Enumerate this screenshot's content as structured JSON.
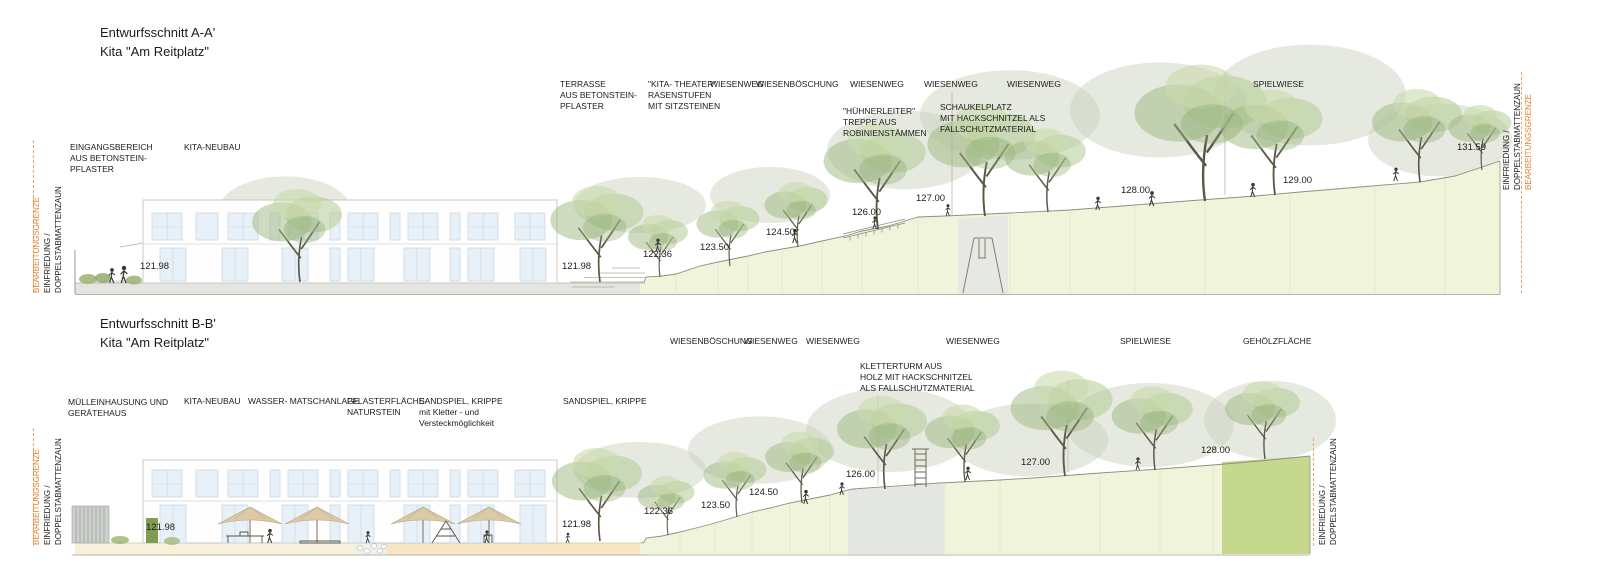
{
  "sections": [
    {
      "name": "A",
      "title": "Entwurfsschnitt A-A'\nKita \"Am Reitplatz\"",
      "edge_left": {
        "grenze": "BEARBEITUNGSGRENZE",
        "fence1": "EINFRIEDUNG /",
        "fence2": "DOPPELSTABMATTENZAUN"
      },
      "edge_right": {
        "fence1": "EINFRIEDUNG /",
        "fence2": "DOPPELSTABMATTENZAUN",
        "grenze": "BEARBEITUNGSGRENZE"
      },
      "labels": [
        "EINGANGSBEREICH\nAUS BETONSTEIN-\nPFLASTER",
        "KITA-NEUBAU",
        "TERRASSE\nAUS BETONSTEIN-\nPFLASTER",
        "\"KITA- THEATER\"\nRASENSTUFEN\nMIT SITZSTEINEN",
        "WIESENWEG",
        "WIESENBÖSCHUNG",
        "WIESENWEG",
        "WIESENWEG",
        "WIESENWEG",
        "SPIELWIESE",
        "\"HÜHNERLEITER\"\nTREPPE AUS\nROBINIENSTÄMMEN",
        "SCHAUKELPLATZ\nMIT HACKSCHNITZEL ALS\nFALLSCHUTZMATERIAL"
      ],
      "elevations": [
        "121.98",
        "121.98",
        "122.36",
        "123.50",
        "124.50",
        "126.00",
        "127.00",
        "128.00",
        "129.00",
        "131.59"
      ]
    },
    {
      "name": "B",
      "title": "Entwurfsschnitt B-B'\nKita \"Am Reitplatz\"",
      "edge_left": {
        "grenze": "BEARBEITUNGSGRENZE",
        "fence1": "EINFRIEDUNG /",
        "fence2": "DOPPELSTABMATTENZAUN"
      },
      "edge_right": {
        "fence1": "EINFRIEDUNG /",
        "fence2": "DOPPELSTABMATTENZAUN"
      },
      "labels": [
        "MÜLLEINHAUSUNG UND\nGERÄTEHAUS",
        "KITA-NEUBAU",
        "WASSER- MATSCHANLAGE",
        "PFLASTERFLÄCHE-\nNATURSTEIN",
        "SANDSPIEL, KRIPPE\nmit Kletter - und\nVersteckmöglichkeit",
        "SANDSPIEL, KRIPPE",
        "WIESENBÖSCHUNG",
        "WIESENWEG",
        "WIESENWEG",
        "WIESENWEG",
        "SPIELWIESE",
        "GEHÖLZFLÄCHE",
        "KLETTERTURM AUS\nHOLZ MIT HACKSCHNITZEL\nALS FALLSCHUTZMATERIAL"
      ],
      "elevations": [
        "121.98",
        "121.98",
        "122.36",
        "123.50",
        "124.50",
        "126.00",
        "127.00",
        "128.00"
      ]
    }
  ],
  "colors": {
    "boundary_orange": "#e87f2e",
    "terrain_fill": "#f0f4da",
    "gehoelz_green": "#c6d88e",
    "block_gray": "#e6e8e3",
    "terrace_gray": "#e4e4e0",
    "terrace_cream": "#f9f0da",
    "terrace_sand": "#f7e5c3",
    "window_blue": "#e9f1f8",
    "umbrella_beige": "#dccaa6"
  }
}
